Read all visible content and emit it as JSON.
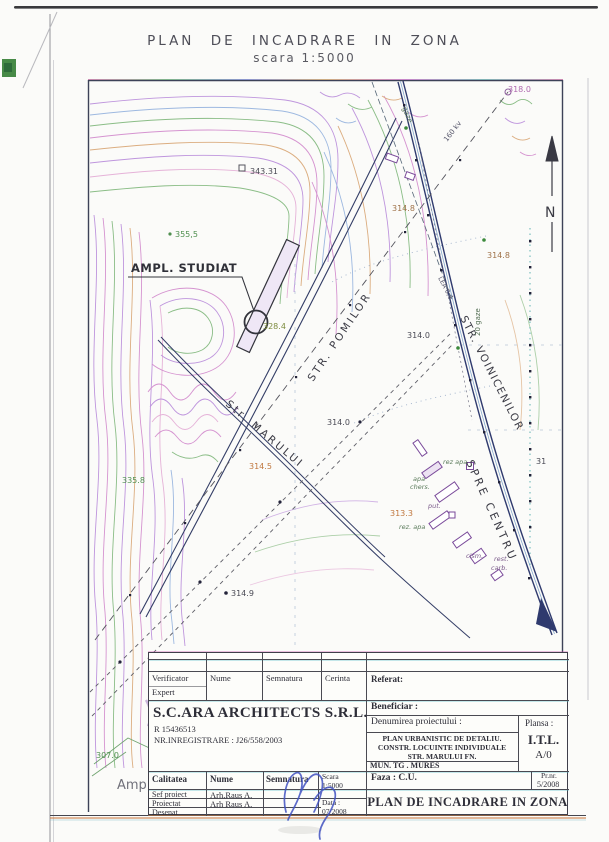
{
  "page": {
    "title": "PLAN  DE  INCADRARE  IN  ZONA",
    "subtitle": "scara  1:5000"
  },
  "map": {
    "north": "N",
    "site_label": "AMPL. STUDIAT",
    "cut_label": "Amp",
    "streets": [
      {
        "n": "STR. POMILOR"
      },
      {
        "n": "Str. MARULUI"
      },
      {
        "n": "STR. VOINICENILOR"
      },
      {
        "n": "SPRE CENTRU"
      }
    ],
    "utils": [
      {
        "n": "gaze"
      },
      {
        "n": "160 kv"
      },
      {
        "n": "20 gaze"
      },
      {
        "n": "LEA 0,4"
      }
    ],
    "elev": [
      {
        "v": "343.31"
      },
      {
        "v": "355,5"
      },
      {
        "v": "328.4"
      },
      {
        "v": "318.0"
      },
      {
        "v": "314.8"
      },
      {
        "v": "314.8"
      },
      {
        "v": "314.0"
      },
      {
        "v": "314.0"
      },
      {
        "v": "314.5"
      },
      {
        "v": "335.8"
      },
      {
        "v": "314.9"
      },
      {
        "v": "313.3"
      },
      {
        "v": "307.0"
      },
      {
        "v": "31"
      }
    ],
    "poi": [
      {
        "v": "rez apa"
      },
      {
        "v": "apa"
      },
      {
        "v": "chers."
      },
      {
        "v": "put."
      },
      {
        "v": "rez. apa"
      },
      {
        "v": "cism."
      },
      {
        "v": "rest."
      },
      {
        "v": "carb."
      }
    ]
  },
  "titleblock": {
    "verificator": "Verificator",
    "expert": "Expert",
    "nume": "Nume",
    "semnatura": "Semnatura",
    "cerinta": "Cerinta",
    "referat": "Referat:",
    "company": "S.C.ARA ARCHITECTS S.R.L.",
    "reg1": "R 15436513",
    "reg2": "NR.INREGISTRARE : J26/558/2003",
    "beneficiar": "Beneficiar :",
    "denumirea": "Denumirea proiectului :",
    "proj1": "PLAN URBANISTIC DE DETALIU.",
    "proj2": "CONSTR. LOCUINTE INDIVIDUALE",
    "proj3": "STR. MARULUI FN.",
    "proj4": "MUN. TG . MURES",
    "plansa_label": "Plansa :",
    "plansa_code": "I.T.L.",
    "plansa_rev": "A/0",
    "calitatea": "Calitatea",
    "nume2": "Nume",
    "semnatura2": "Semnatura",
    "scara_label": "Scara",
    "scara_value": "1:5000",
    "faza": "Faza : C.U.",
    "prnr_label": "Pr.nr.",
    "prnr_value": "5/2008",
    "rows": [
      {
        "role": "Sef proiect",
        "name": "Arh.Raus A."
      },
      {
        "role": "Proiectat",
        "name": "Arh Raus A."
      },
      {
        "role": "Desenat",
        "name": ""
      }
    ],
    "data_label": "Data :",
    "data_value": "07/2008",
    "drawing_title": "PLAN DE INCADRARE IN ZONA"
  }
}
